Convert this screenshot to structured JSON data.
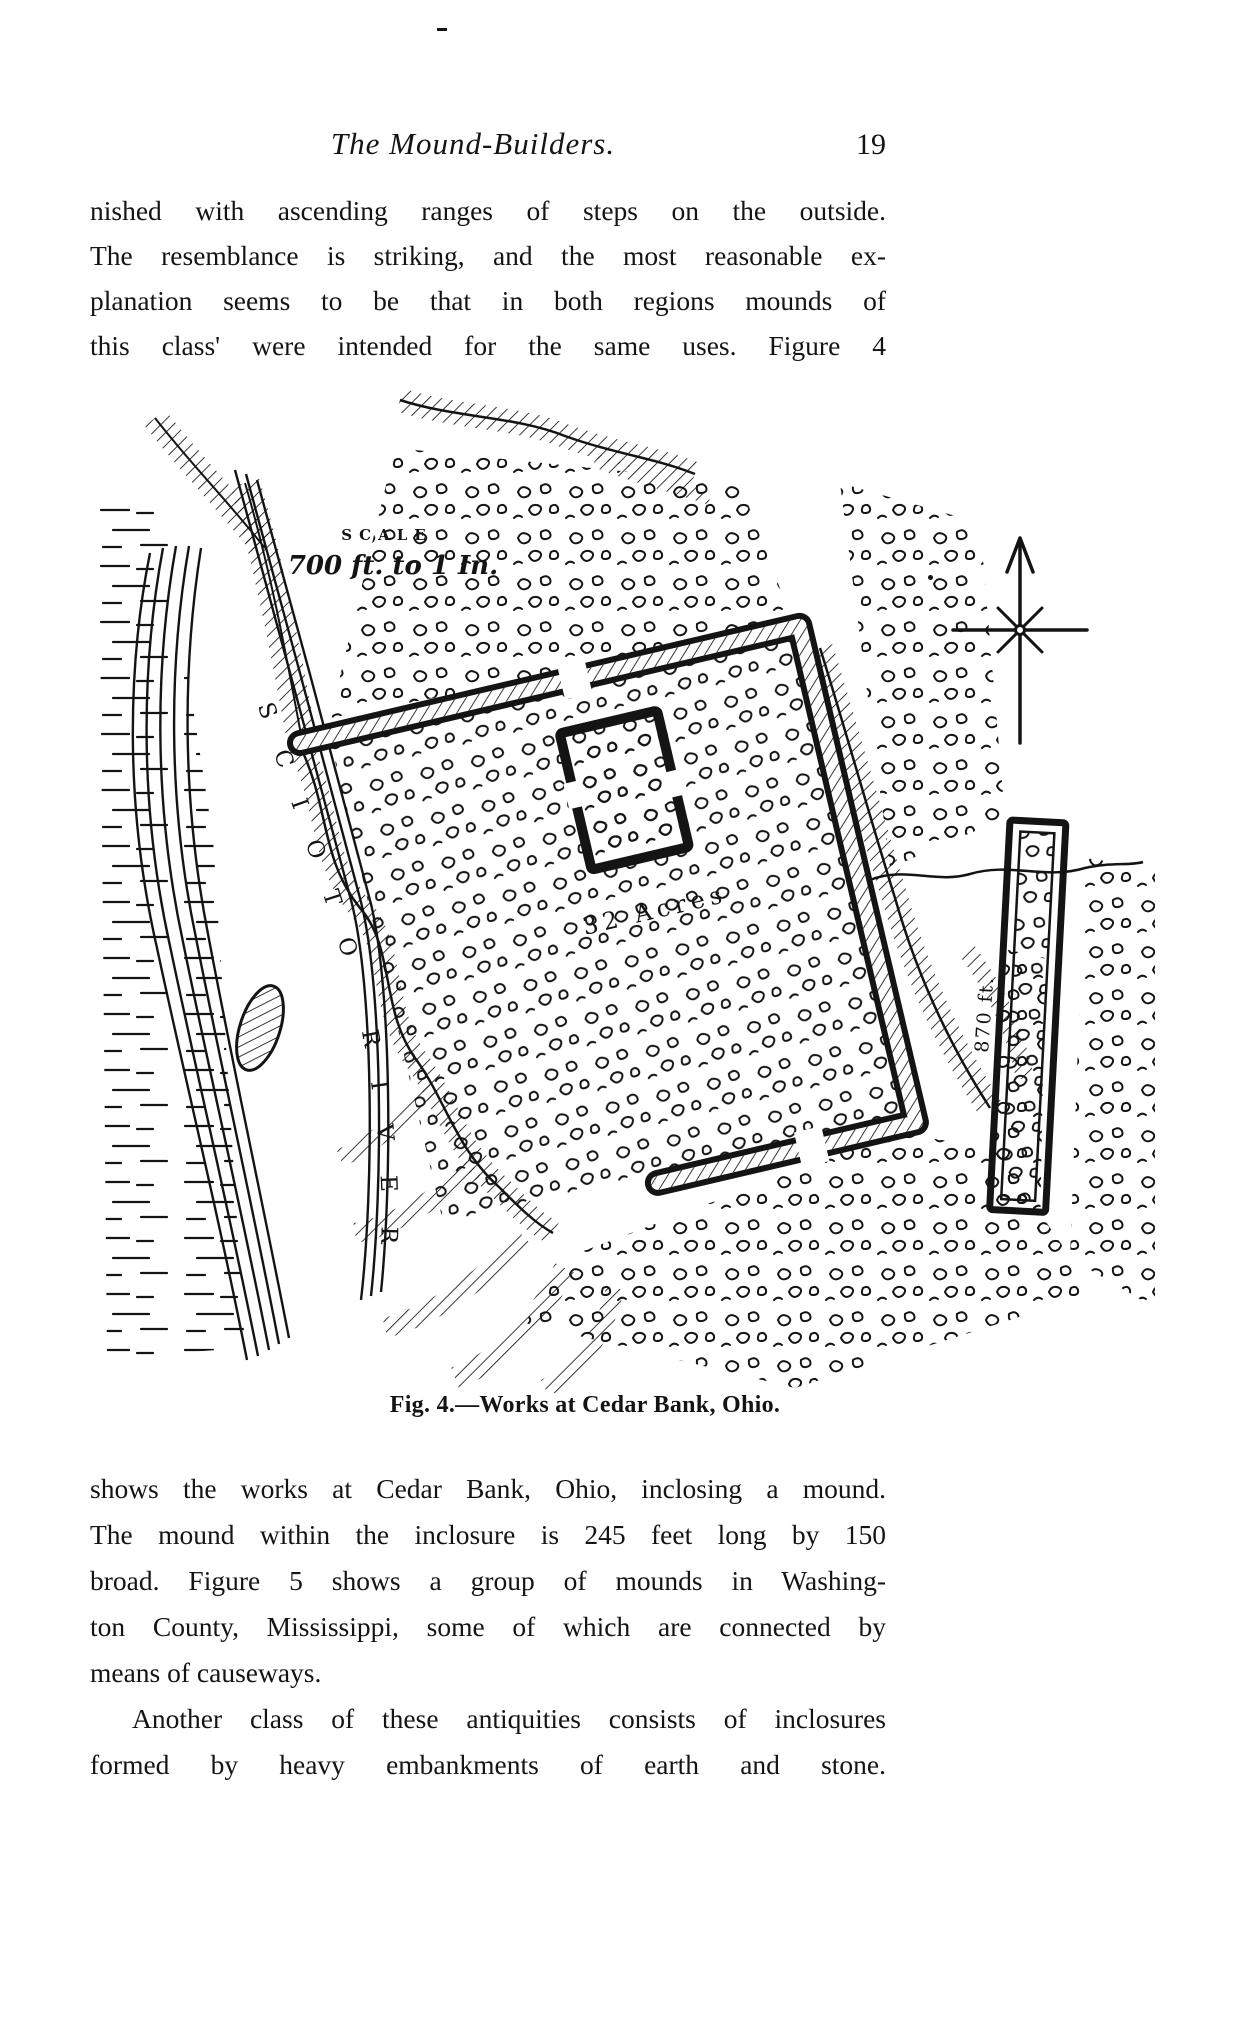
{
  "header": {
    "title": "The Mound-Builders.",
    "page_number": "19"
  },
  "paragraphs": {
    "p1": [
      "nished with ascending ranges of steps on the outside.",
      "The resemblance is striking, and the most reasonable ex-",
      "planation seems to be that in both regions mounds of",
      "this class' were intended for the same uses.  Figure 4"
    ],
    "p2": [
      "shows the works at Cedar Bank, Ohio, inclosing a mound.",
      "The mound within the inclosure is 245 feet long by 150",
      "broad.  Figure 5 shows a group of mounds in Washing-",
      "ton County, Mississippi, some of which are connected by",
      "means of causeways."
    ],
    "p3": [
      "Another class of these antiquities consists of inclosures",
      "formed by heavy embankments of earth and stone."
    ]
  },
  "figure": {
    "scale_heading": "SCALE",
    "scale_value": "700 ft. to 1 In.",
    "river_label": "SCIOTO RIVER",
    "area_label": "32 Acres",
    "embankment_length": "870 ft.",
    "caption": "Fig. 4.—Works at Cedar Bank, Ohio."
  },
  "colors": {
    "ink": "#141414",
    "paper": "#ffffff"
  }
}
